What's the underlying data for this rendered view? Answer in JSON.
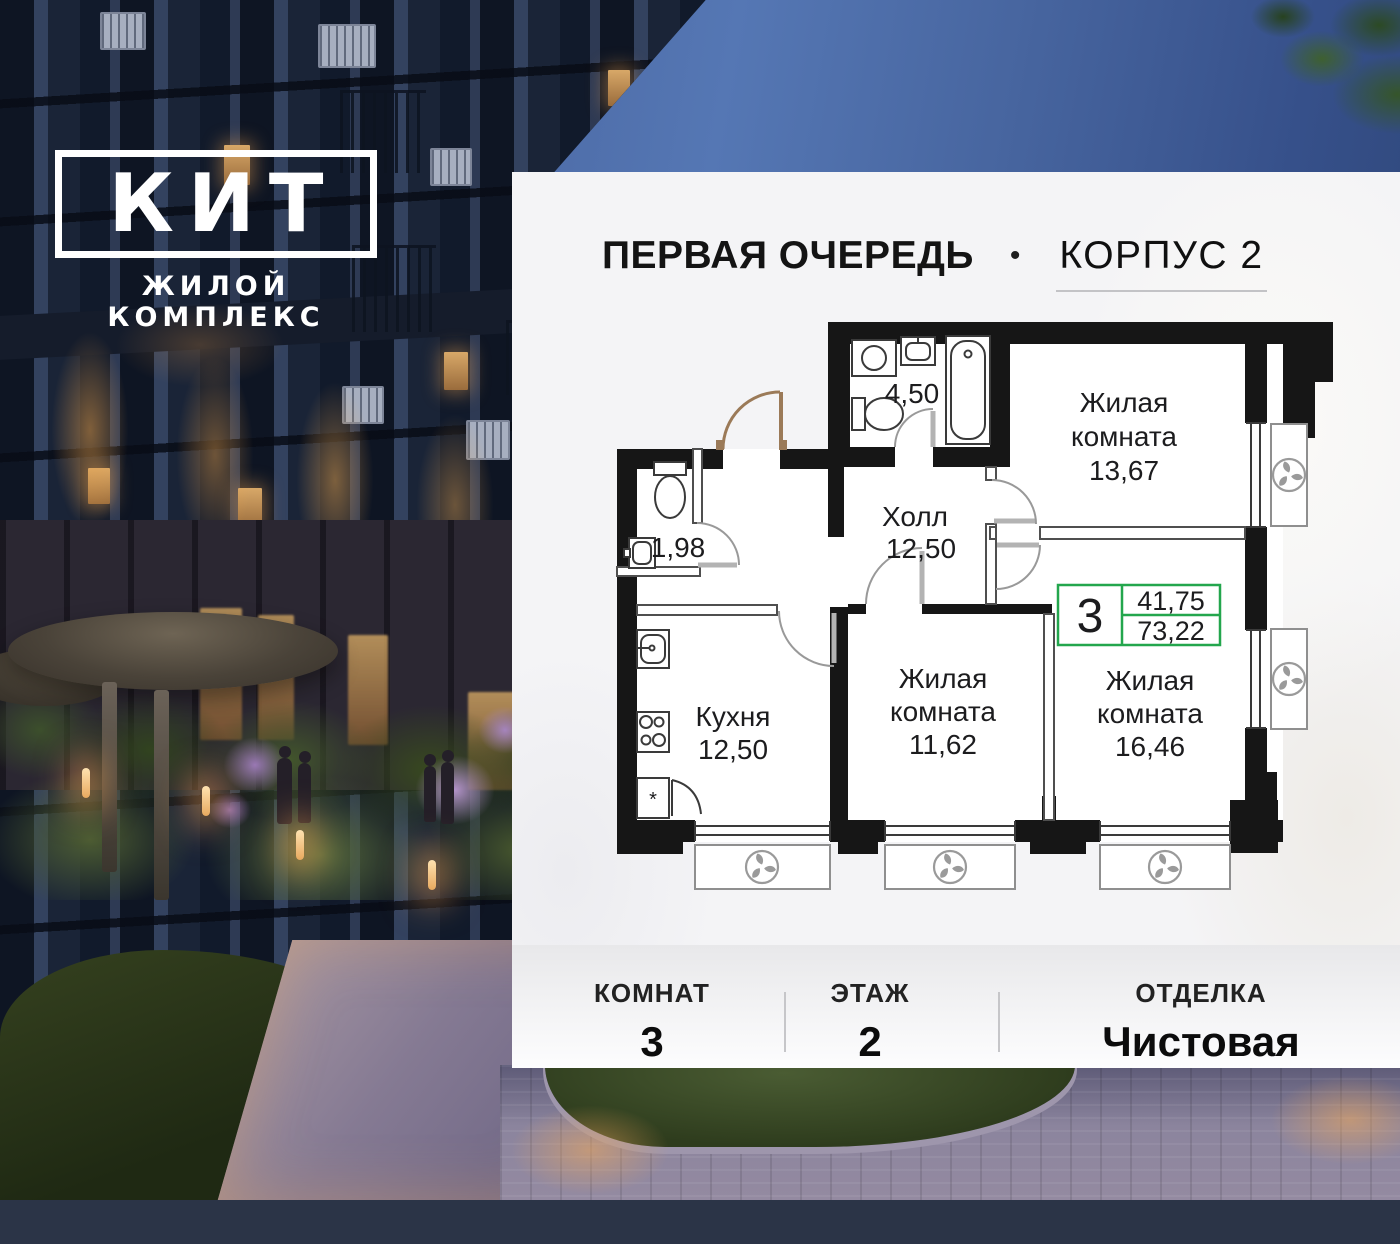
{
  "logo": {
    "title": "КИТ",
    "subtitle": "ЖИЛОЙ КОМПЛЕКС"
  },
  "header": {
    "phase": "ПЕРВАЯ ОЧЕРЕДЬ",
    "separator": "•",
    "building": "КОРПУС 2"
  },
  "plan": {
    "bathroom": {
      "area": "4,50"
    },
    "wc": {
      "area": "1,98"
    },
    "hall": {
      "name": "Холл",
      "area": "12,50"
    },
    "kitchen": {
      "name": "Кухня",
      "area": "12,50"
    },
    "living_room_1": {
      "name_line1": "Жилая",
      "name_line2": "комната",
      "area": "13,67"
    },
    "living_room_2": {
      "name_line1": "Жилая",
      "name_line2": "комната",
      "area": "11,62"
    },
    "living_room_3": {
      "name_line1": "Жилая",
      "name_line2": "комната",
      "area": "16,46"
    },
    "badge": {
      "rooms_count": "3",
      "living_area": "41,75",
      "total_area": "73,22"
    },
    "fridge_mark": "*"
  },
  "footer": {
    "columns": [
      {
        "label": "КОМНАТ",
        "value": "3"
      },
      {
        "label": "ЭТАЖ",
        "value": "2"
      },
      {
        "label": "ОТДЕЛКА",
        "value": "Чистовая"
      }
    ]
  },
  "colors": {
    "accent_green": "#23A64D",
    "entrance_door_brown": "#9B7A58",
    "wall_black": "#161616"
  }
}
